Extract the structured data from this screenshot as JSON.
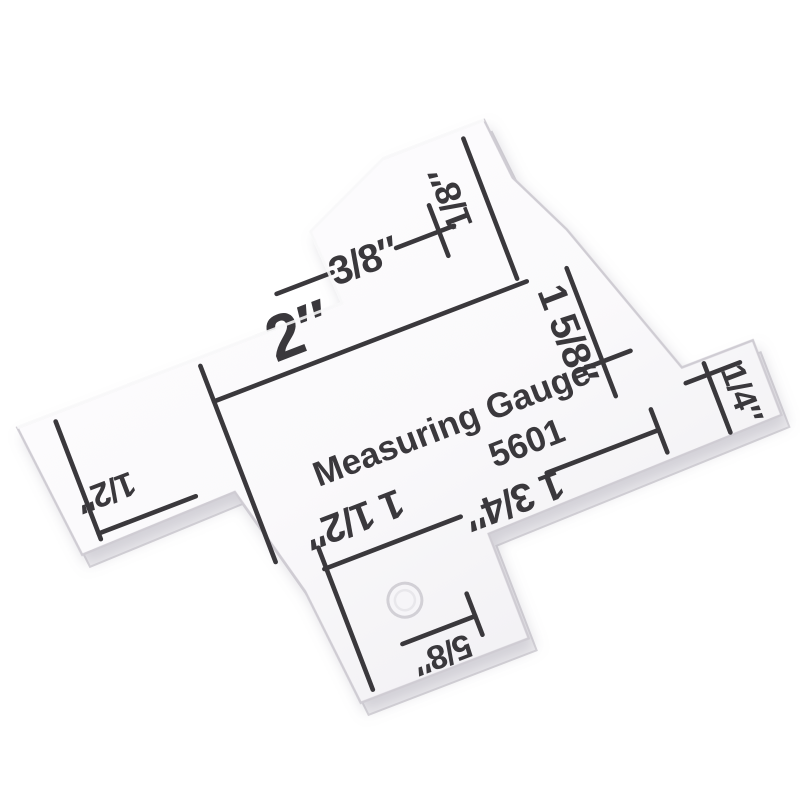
{
  "page": {
    "background": "#ffffff",
    "description": "product photo of a clear acrylic measuring gauge on white background"
  },
  "gauge": {
    "title": "Measuring Gauge",
    "model": "5601",
    "ink_color": "#3a383c",
    "edge_color": "#cfccd3",
    "plate_tint_top": "#fdfcfe",
    "plate_tint_bottom": "#f3f2f5",
    "measurements": [
      {
        "label": "3/8″"
      },
      {
        "label": "1/8″"
      },
      {
        "label": "2″"
      },
      {
        "label": "1 5/8″"
      },
      {
        "label": "1/4″"
      },
      {
        "label": "1/2″"
      },
      {
        "label": "1 1/2″"
      },
      {
        "label": "1 3/4″"
      },
      {
        "label": "5/8″"
      }
    ]
  }
}
